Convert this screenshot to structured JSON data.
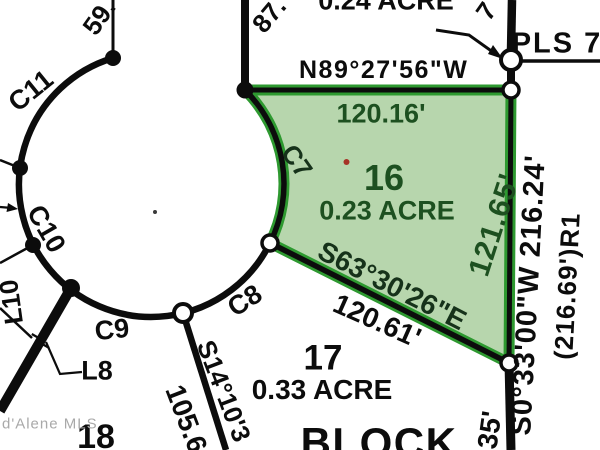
{
  "watermark": "d'Alene MLS",
  "block_label": "BLOCK",
  "monument_label": "PLS 7",
  "lots": {
    "lot15": {
      "area": "0.24 ACRE"
    },
    "lot16": {
      "number": "16",
      "area": "0.23 ACRE"
    },
    "lot17": {
      "number": "17",
      "area": "0.33 ACRE"
    },
    "lot18": {
      "number": "18"
    }
  },
  "dimensions": {
    "north_bearing": "N89°27'56\"W",
    "north_distance": "120.16'",
    "east_lot_distance": "121.65'",
    "east_bearing_distance": "S0°33'00\"W 216.24'",
    "east_record": "(216.69')R1",
    "east_offset": "35'",
    "south_bearing": "S63°30'26\"E",
    "south_distance": "120.61'",
    "southwest_bearing": "S14°10'3",
    "southwest_distance": "105.6",
    "partial_top_left": "59.",
    "partial_top_mid": "87.",
    "partial_top_right": "7"
  },
  "curves": {
    "c7": "C7",
    "c8": "C8",
    "c9": "C9",
    "c10": "C10",
    "c11": "C11",
    "l8": "L8",
    "l10": "L10"
  },
  "colors": {
    "highlight_fill": "#b7d6ad",
    "highlight_stroke": "#2e9930",
    "annotation_green": "#1d5020",
    "line_black": "#0c0c0c",
    "watermark_gray": "#a9a9a9",
    "red_mark": "#a63326"
  }
}
